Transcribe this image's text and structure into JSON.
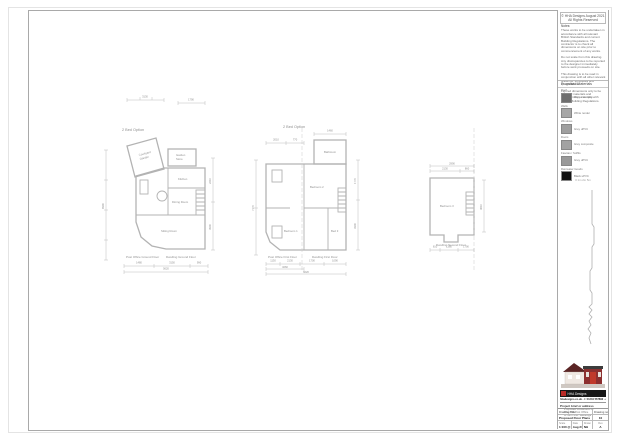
{
  "page": {
    "copyright_line1": "© HHA Designs August 2021",
    "copyright_line2": "All Rights Reserved",
    "notes_title": "Notes:",
    "notes": [
      "These works to be undertaken in accordance with all relevant British Standards and current Building Regulations. The contractor is to check all dimensions on site prior to commencement of any works.",
      "Do not scale from this drawing. Any discrepancies to be reported to the designer immediately before work proceeds on site.",
      "This drawing is to be read in conjunction with all other relevant drawings, schedules and specifications.",
      "Figured dimensions only to be used. All materials and workmanship to comply with current Building Regulations."
    ],
    "materials_title": "Proposed Materials",
    "materials": [
      {
        "heading": "Roof",
        "label": "Grey slate tiles",
        "color": "#6f6f6f"
      },
      {
        "heading": "Walls",
        "label": "White render",
        "color": "#a6a6a6"
      },
      {
        "heading": "Windows",
        "label": "Grey uPVC",
        "color": "#9f9f9f"
      },
      {
        "heading": "Doors",
        "label": "Grey composite",
        "color": "#a2a2a2"
      },
      {
        "heading": "Fascias / Soffits",
        "label": "Grey uPVC",
        "color": "#999999"
      },
      {
        "heading": "Rainwater Goods",
        "label": "Black uPVC",
        "color": "#111111"
      }
    ],
    "scale_note": "0   1m   2m   5m"
  },
  "plans": {
    "plan1": {
      "title": "2 Bed Option",
      "rooms": {
        "courtyard_1": "Courtyard",
        "courtyard_2": "Garden",
        "store_1": "Garden",
        "store_2": "Store",
        "kitchen": "Kitchen",
        "dining": "Dining Room",
        "sitting": "Sitting Room"
      },
      "caption_left": "Post Office Ground Floor",
      "caption_right": "Dwelling Ground Floor",
      "dims": {
        "top_a": "3130",
        "top_b": "1790",
        "left": "8390",
        "right_a": "2210",
        "right_b": "3900",
        "bot_a": "1480",
        "bot_b": "3150",
        "bot_c": "990",
        "bot_total": "5620"
      }
    },
    "plan2": {
      "title": "2 Bed Option",
      "rooms": {
        "bathroom": "Bathroom",
        "bedroom2": "Bedroom 2",
        "bedroom1": "Bedroom 1",
        "bed3": "Bed 3"
      },
      "caption_left": "Post Office First Floor",
      "caption_right": "Dwelling First Floor",
      "dims": {
        "top_a": "2010",
        "top_b": "770",
        "top_c": "1460",
        "left": "7170",
        "right_a": "1770",
        "right_b": "3300",
        "bot_a": "1130",
        "bot_b": "2130",
        "bot_c": "1700",
        "bot_d": "1090",
        "bot_mid": "3260",
        "bot_total": "6620"
      }
    },
    "plan3": {
      "rooms": {
        "bedroom3": "Bedroom 3"
      },
      "caption": "Dwelling Second Floor",
      "dims": {
        "top_total": "2990",
        "top_a": "2130",
        "top_b": "860",
        "right": "3610",
        "bot_a": "610",
        "bot_b": "1380",
        "bot_c": "1790"
      }
    }
  },
  "brand": {
    "name": "HHA Designs",
    "contact": "hhadesigns.co.uk  ·  t: 01234 567890  ·  e: info@hhadesigns.co.uk"
  },
  "project": {
    "label": "Project brief or address",
    "lines": [
      "Proposed conversion of",
      "The Old Post Office",
      "to form 2no. dwellings"
    ]
  },
  "titleblock": {
    "drawing_title_label": "Drawing Title",
    "drawing_title": "Proposed Floor Plans",
    "drawing_no_label": "Drawing no.",
    "drawing_no": "10",
    "scale_label": "Scale",
    "scale": "1:100 @ A3",
    "date_label": "Date",
    "date": "Aug 21",
    "drawn_label": "Drawn",
    "drawn": "NH",
    "rev_label": "Rev",
    "rev": "A"
  }
}
